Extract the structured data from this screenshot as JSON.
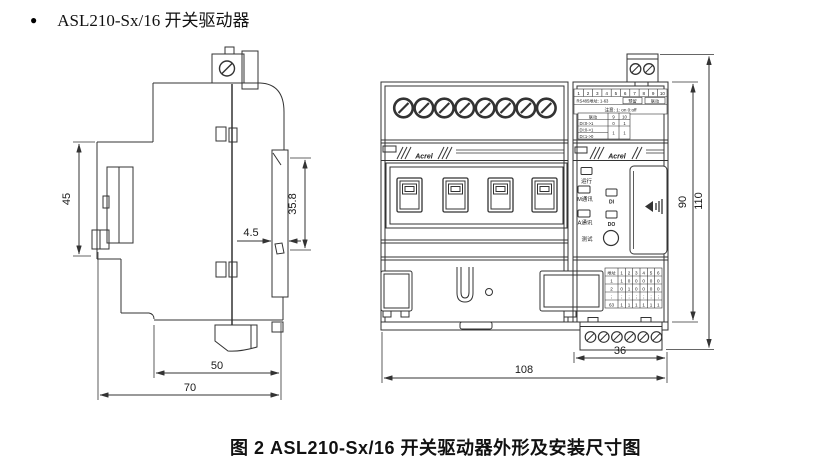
{
  "title": {
    "bullet": "●",
    "text": "ASL210-Sx/16 开关驱动器"
  },
  "caption": "图 2  ASL210-Sx/16 开关驱动器外形及安装尺寸图",
  "side_view": {
    "dim_45": "45",
    "dim_35_8": "35.8",
    "dim_4_5": "4.5",
    "dim_50": "50",
    "dim_70": "70"
  },
  "front_view": {
    "brand": "Acrel",
    "dim_90": "90",
    "dim_110": "110",
    "dim_108": "108",
    "dim_36": "36",
    "dip_label": {
      "numbers": [
        "1",
        "2",
        "3",
        "4",
        "5",
        "6",
        "7",
        "8",
        "9",
        "10"
      ],
      "addr_text": "RS485地址: 1-63",
      "box1": "预留",
      "box2": "联动",
      "note": "注意: 1: on 0:off"
    },
    "linkage_table": {
      "h_label": "联动",
      "h_col9": "9",
      "h_col10": "10",
      "r1_label": "DI:0->1",
      "r1_v9": "0",
      "r1_v10": "1",
      "r2_label": "DI:0->1",
      "r3_label": "DI:1->0",
      "m_v9": "1",
      "m_v10": "1"
    },
    "leds": {
      "run": "运行",
      "m_comm": "M通讯",
      "a_comm": "A通讯",
      "di": "DI",
      "dout": "DO",
      "test": "测试"
    },
    "address_table": {
      "header": [
        "地址",
        "1",
        "2",
        "3",
        "4",
        "5",
        "6"
      ],
      "row1": [
        "1",
        "1",
        "0",
        "0",
        "0",
        "0",
        "0"
      ],
      "row2": [
        "2",
        "0",
        "1",
        "0",
        "0",
        "0",
        "0"
      ],
      "dots": "⋮",
      "row63": [
        "63",
        "1",
        "1",
        "1",
        "1",
        "1",
        "1"
      ]
    }
  }
}
